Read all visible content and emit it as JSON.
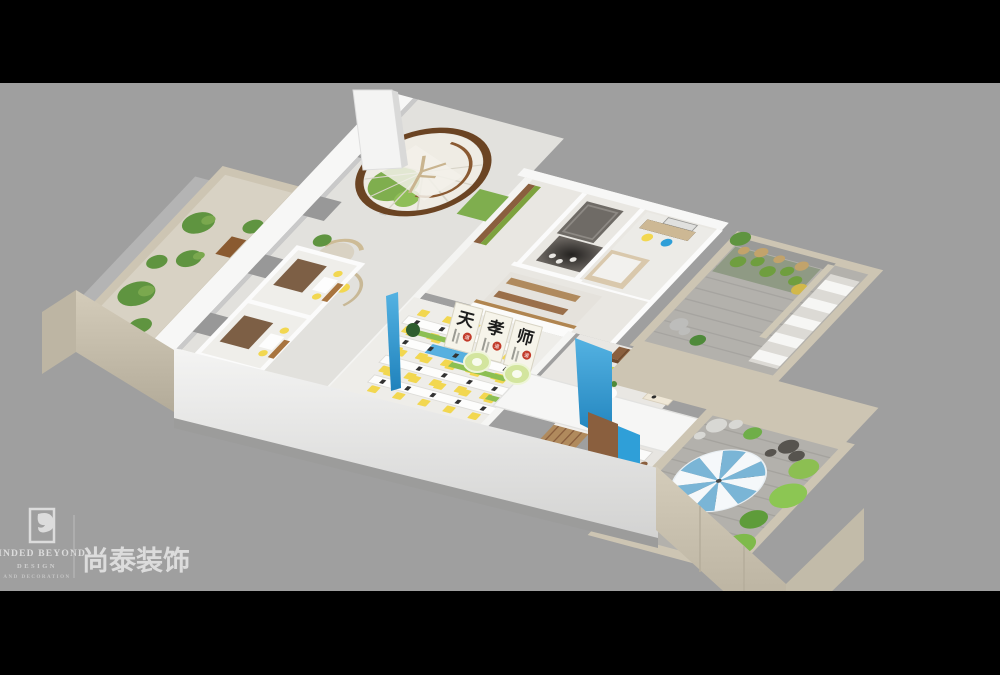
{
  "logo": {
    "brand_en": "MINDED BEYOND",
    "brand_line2": "DESIGN",
    "brand_line3": "AND DECORATION",
    "brand_cn": "尚泰装饰",
    "icon": "bird-in-frame",
    "text_color": "#dcdcdc"
  },
  "scene": {
    "posters": [
      {
        "char": "天",
        "seal": "道"
      },
      {
        "char": "孝",
        "seal": "道"
      },
      {
        "char": "师",
        "seal": "道"
      }
    ]
  },
  "palette": {
    "canvas_bg": "#9f9f9f",
    "bar_black": "#000000",
    "wall_white": "#f7f7f6",
    "wall_face": "#ededec",
    "beige_wall": "#cdc5b3",
    "beige_face": "#c2bba9",
    "brick_gray": "#989898",
    "tile_gray": "#b3b1ac",
    "floor_light": "#e6e5e1",
    "wood_dark": "#6b4423",
    "wood_mid": "#8a5f3e",
    "wood_light": "#b08a5d",
    "plant_green": "#5f9440",
    "plant_light": "#8cbf52",
    "lawn_green": "#7fae4e",
    "chair_yellow": "#f2d750",
    "accent_blue": "#2f9fd8",
    "umbrella_blue": "#7ab5d6",
    "umbrella_white": "#f5f8fa",
    "poster_paper": "#f6f4ea",
    "ink_black": "#1d1d1d",
    "seal_red": "#c23b2a",
    "lamp_green": "#d3e59e",
    "tatami_brown": "#7d5f45",
    "logo_text": "#dcdcdc"
  }
}
